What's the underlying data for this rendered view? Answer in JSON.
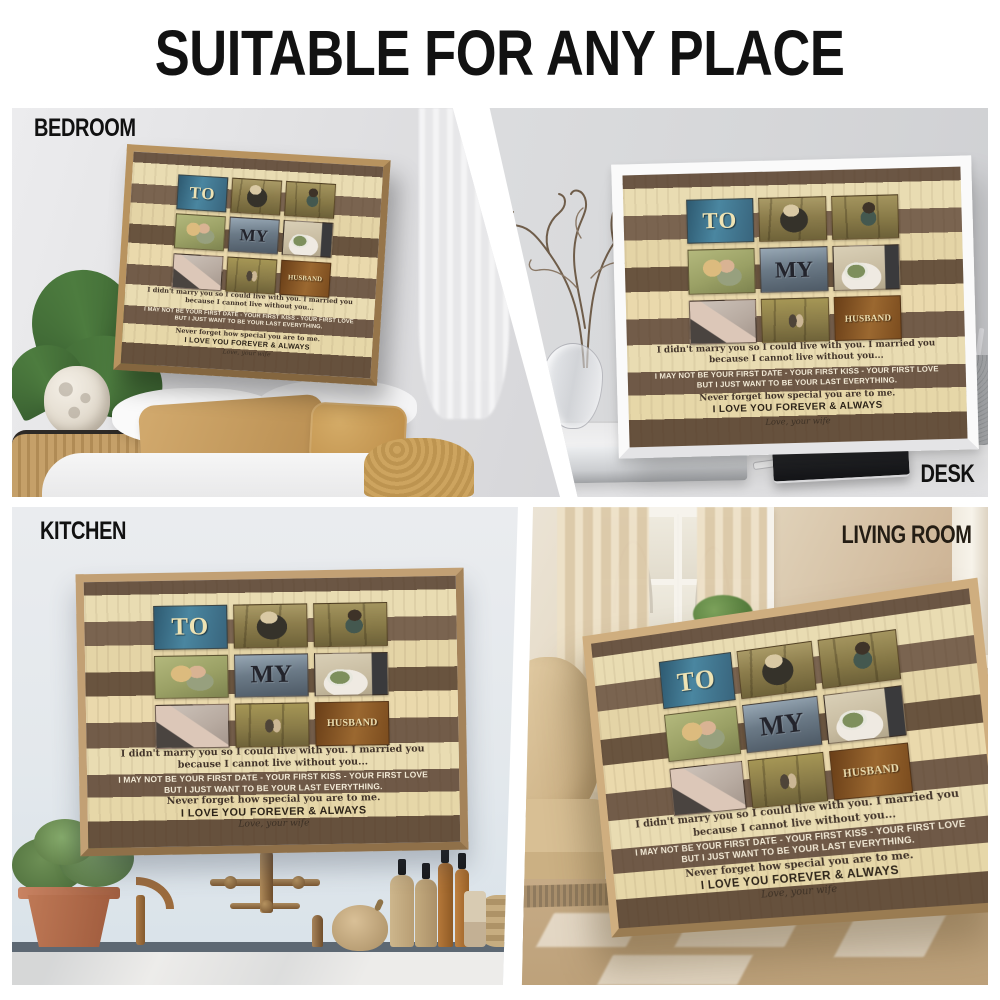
{
  "header": {
    "title": "SUITABLE FOR ANY PLACE"
  },
  "sections": [
    {
      "id": "bedroom",
      "label": "BEDROOM",
      "label_position": "top-left"
    },
    {
      "id": "desk",
      "label": "DESK",
      "label_position": "bottom-right"
    },
    {
      "id": "kitchen",
      "label": "KITCHEN",
      "label_position": "top-left"
    },
    {
      "id": "living-room",
      "label": "LIVING ROOM",
      "label_position": "top-right"
    }
  ],
  "canvas_print": {
    "title_words": [
      "TO",
      "MY",
      "HUSBAND"
    ],
    "poem": [
      "I didn't marry you so I could live with you. I married you",
      "because I cannot live without you...",
      "I MAY NOT BE YOUR FIRST DATE - YOUR FIRST KISS - YOUR FIRST LOVE",
      "BUT I JUST WANT TO BE YOUR LAST EVERYTHING.",
      "Never forget how special you are to me.",
      "I LOVE YOU FOREVER & ALWAYS",
      "Love, your wife"
    ],
    "photos": [
      "couple-kissing-in-orchard",
      "couple-piggyback",
      "couple-hugging",
      "wedding-bouquet-hands",
      "hands-with-engagement-ring",
      "couple-walking-in-orchard"
    ],
    "colors": {
      "to_tile": "#3d6e83",
      "my_tile": "#74858f",
      "husband_tile": "#8a5a2c",
      "plank_dark": "#6e5846",
      "plank_light": "#e8dbb0",
      "frame_wood": "#c4a277",
      "frame_white": "#fafafa"
    }
  }
}
